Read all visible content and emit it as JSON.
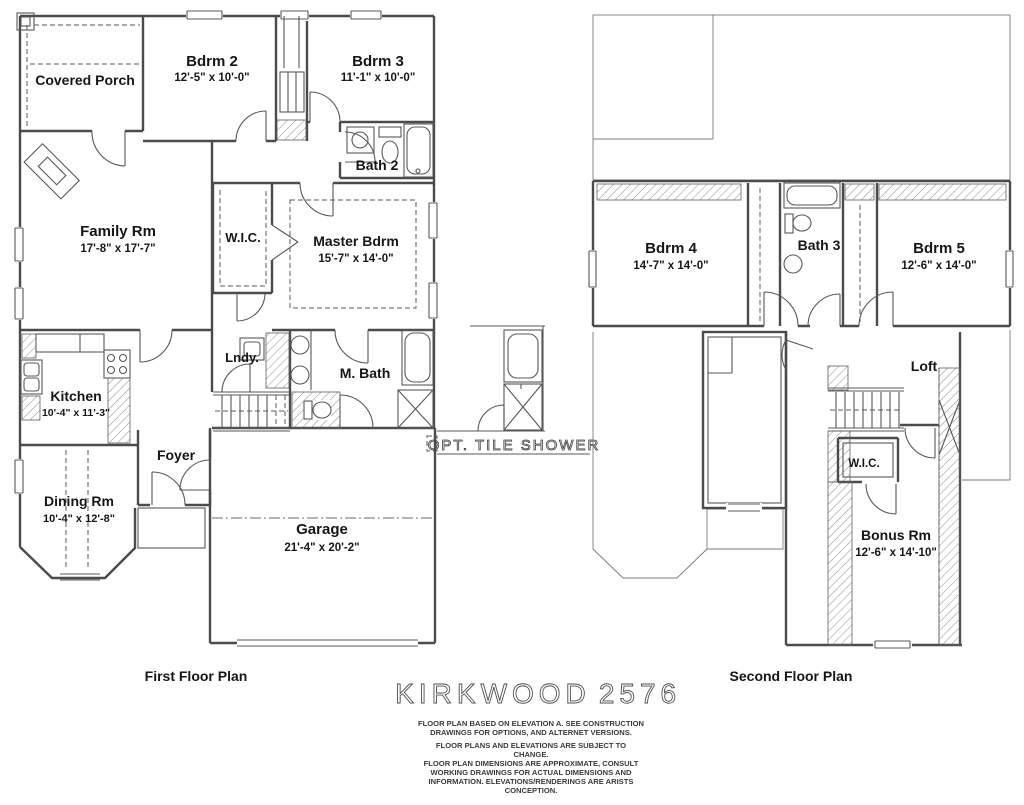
{
  "colors": {
    "background": "#ffffff",
    "ink": "#4b4b4b",
    "label_text": "#161616",
    "hatch": "#5f5f5f"
  },
  "title": {
    "name": "KIRKWOOD",
    "number": "2576"
  },
  "inset": {
    "label": "OPT.  TILE  SHOWER"
  },
  "first_floor": {
    "caption": "First Floor Plan",
    "covered_porch": "Covered Porch",
    "bdrm2": "Bdrm 2",
    "bdrm2_dims": "12'-5\" x 10'-0\"",
    "bdrm3": "Bdrm 3",
    "bdrm3_dims": "11'-1\" x 10'-0\"",
    "bath2": "Bath 2",
    "family": "Family Rm",
    "family_dims": "17'-8\" x 17'-7\"",
    "wic": "W.I.C.",
    "master": "Master Bdrm",
    "master_dims": "15'-7\" x 14'-0\"",
    "kitchen": "Kitchen",
    "kitchen_dims": "10'-4\" x 11'-3\"",
    "lndy": "Lndy.",
    "mbath": "M. Bath",
    "foyer": "Foyer",
    "dining": "Dining Rm",
    "dining_dims": "10'-4\" x 12'-8\"",
    "garage": "Garage",
    "garage_dims": "21'-4\" x 20'-2\""
  },
  "second_floor": {
    "caption": "Second Floor Plan",
    "bdrm4": "Bdrm 4",
    "bdrm4_dims": "14'-7\" x 14'-0\"",
    "bath3": "Bath 3",
    "bdrm5": "Bdrm 5",
    "bdrm5_dims": "12'-6\" x 14'-0\"",
    "loft": "Loft",
    "wic": "W.I.C.",
    "bonus": "Bonus Rm",
    "bonus_dims": "12'-6\" x 14'-10\""
  },
  "disclaimer": {
    "lines": [
      "FLOOR PLAN BASED ON ELEVATION A. SEE CONSTRUCTION",
      "DRAWINGS FOR OPTIONS, AND ALTERNET VERSIONS.",
      "FLOOR PLANS AND ELEVATIONS ARE SUBJECT TO",
      "CHANGE.",
      "FLOOR PLAN DIMENSIONS ARE APPROXIMATE, CONSULT",
      "WORKING DRAWINGS FOR ACTUAL DIMENSIONS AND",
      "INFORMATION. ELEVATIONS/RENDERINGS ARE ARISTS",
      "CONCEPTION."
    ]
  }
}
